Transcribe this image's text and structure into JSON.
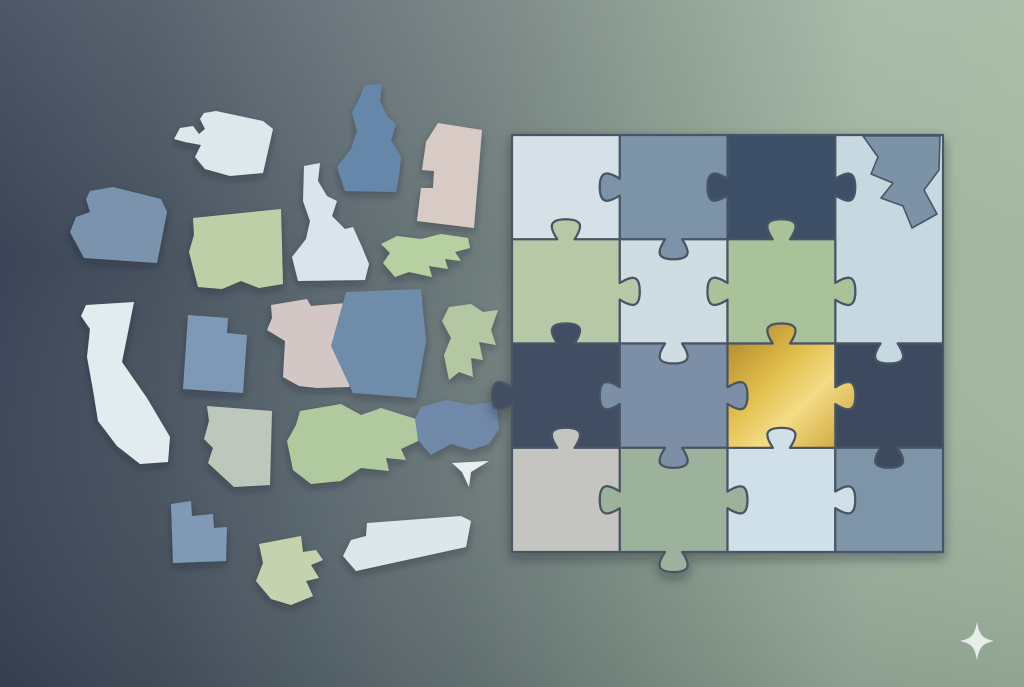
{
  "canvas": {
    "width": 1024,
    "height": 687
  },
  "background": {
    "horizontal_stops": [
      {
        "offset": "0%",
        "color": "#3a4457"
      },
      {
        "offset": "15%",
        "color": "#47525f"
      },
      {
        "offset": "32%",
        "color": "#5c6970"
      },
      {
        "offset": "48%",
        "color": "#6f7d7c"
      },
      {
        "offset": "66%",
        "color": "#879a8c"
      },
      {
        "offset": "84%",
        "color": "#9fb3a0"
      },
      {
        "offset": "100%",
        "color": "#a3b7a0"
      }
    ],
    "vertical_overlay_stops": [
      {
        "offset": "0%",
        "color": "rgba(255,255,255,0.10)"
      },
      {
        "offset": "38%",
        "color": "rgba(255,255,255,0)"
      },
      {
        "offset": "100%",
        "color": "rgba(12,22,32,0.12)"
      }
    ]
  },
  "scattered_states": [
    {
      "name": "washington-state",
      "color": "#dde8ec",
      "points": "204,113 216,111 263,121 273,129 263,173 230,176 205,169 195,157 201,145 185,142 174,139 180,128 193,126 199,134 205,129 200,119"
    },
    {
      "name": "idaho-state",
      "color": "#6587aa",
      "points": "365,85 382,84 380,101 387,116 396,124 391,140 401,157 399,176 396,192 345,191 337,167 351,149 357,131 352,113 359,99"
    },
    {
      "name": "beige-tab-card",
      "color": "#d8cbc5",
      "points": "438,123 482,130 474,228 417,221 421,188 433,188 434,171 422,170 426,142"
    },
    {
      "name": "oregon-state",
      "color": "#7b93ad",
      "points": "90,191 113,187 161,199 167,212 157,263 84,258 70,232 76,217 90,212 86,199"
    },
    {
      "name": "montana-state",
      "color": "#bccfa6",
      "points": "193,218 281,209 283,284 259,288 241,281 222,289 198,287 189,252 194,235"
    },
    {
      "name": "idaho-light-state",
      "color": "#d9e5ea",
      "points": "304,166 320,163 318,181 327,196 337,201 332,216 345,229 353,227 362,247 369,264 365,280 298,281 292,257 306,239 310,221 303,201"
    },
    {
      "name": "jagged-green-strip",
      "color": "#b7d0a2",
      "points": "381,244 397,236 421,239 441,234 468,238 470,248 455,252 461,261 445,259 448,269 429,266 432,277 409,272 395,277 383,263 390,253"
    },
    {
      "name": "california-state",
      "color": "#e2ebee",
      "points": "86,305 134,302 122,362 147,398 170,437 168,462 140,464 117,446 98,421 93,390 87,357 90,329 81,316"
    },
    {
      "name": "utah-state",
      "color": "#7e99b5",
      "points": "188,315 228,318 227,333 247,335 243,393 183,389"
    },
    {
      "name": "missouri-state",
      "color": "#d2c7c4",
      "points": "271,305 307,299 311,306 346,303 352,313 345,321 354,332 357,369 349,387 317,388 299,386 283,377 285,341 267,330 272,318"
    },
    {
      "name": "blue-slab-state",
      "color": "#6f8cab",
      "points": "346,292 421,289 426,341 416,398 353,393 331,346 339,317"
    },
    {
      "name": "green-fragment-state",
      "color": "#b3c7a2",
      "points": "449,307 471,304 483,312 498,310 491,330 496,345 479,342 483,360 471,358 473,377 459,372 449,380 444,355 451,338 442,321"
    },
    {
      "name": "arizona-state",
      "color": "#bec7bb",
      "points": "207,406 272,411 270,485 234,487 208,463 213,448 204,439 209,421"
    },
    {
      "name": "kentucky-state",
      "color": "#b0c99f",
      "points": "300,411 341,404 361,415 381,408 416,419 418,441 401,449 406,460 386,458 389,471 361,468 341,481 311,484 293,470 287,441 296,425"
    },
    {
      "name": "ohio-state",
      "color": "#7089a8",
      "points": "421,407 446,400 471,405 496,401 499,429 489,444 471,450 451,444 431,455 418,440 415,419"
    },
    {
      "name": "paper-funnel-shape",
      "color": "#e9eff1",
      "points": "452,463 489,461 471,472 469,487 462,472"
    },
    {
      "name": "utah-small-state",
      "color": "#8099b4",
      "points": "171,504 191,501 192,516 213,514 214,528 227,527 226,561 173,563"
    },
    {
      "name": "green-boot-state",
      "color": "#c4d3ad",
      "points": "259,544 301,536 303,552 316,550 323,560 311,565 319,578 306,581 313,596 291,605 271,599 256,581 263,563"
    },
    {
      "name": "tennessee-light-state",
      "color": "#dde7eb",
      "points": "351,540 366,536 367,523 461,516 471,521 466,547 356,571 343,556"
    }
  ],
  "puzzle": {
    "origin_x": 512,
    "origin_y": 135,
    "cols": 4,
    "rows": 4,
    "cell_width": 107.75,
    "cell_height": 104.25,
    "tab_depth": 20,
    "stroke_color": "#4a5565",
    "stroke_width": 2.2,
    "gold_gradient_stops": [
      {
        "offset": "0%",
        "color": "#ab8226"
      },
      {
        "offset": "40%",
        "color": "#e3bf4e"
      },
      {
        "offset": "62%",
        "color": "#f3dc85"
      },
      {
        "offset": "100%",
        "color": "#c99f33"
      }
    ],
    "h_tabs": [
      [
        0,
        0,
        0,
        0
      ],
      [
        1,
        -1,
        1,
        0
      ],
      [
        1,
        -1,
        1,
        -1
      ],
      [
        1,
        -1,
        1,
        -1
      ],
      [
        0,
        -1,
        0,
        0
      ]
    ],
    "v_tabs": [
      [
        0,
        1,
        1,
        -1,
        0
      ],
      [
        0,
        -1,
        1,
        -1,
        0
      ],
      [
        1,
        1,
        -1,
        -1,
        0
      ],
      [
        0,
        1,
        -1,
        -1,
        0
      ]
    ],
    "pieces": [
      {
        "name": "puzzle-piece-r1c1",
        "r": 0,
        "c": 0,
        "color": "#d5e1e7"
      },
      {
        "name": "puzzle-piece-r1c2",
        "r": 0,
        "c": 1,
        "color": "#7d94a8"
      },
      {
        "name": "puzzle-piece-r1c3",
        "r": 0,
        "c": 2,
        "color": "#3e4f66"
      },
      {
        "name": "puzzle-piece-r1c4-tall",
        "r": 0,
        "c": 3,
        "rs": 2,
        "color": "#c6d9e1"
      },
      {
        "name": "puzzle-piece-r2c1",
        "r": 1,
        "c": 0,
        "color": "#b7c8a6"
      },
      {
        "name": "puzzle-piece-r2c2",
        "r": 1,
        "c": 1,
        "color": "#cfdde2"
      },
      {
        "name": "puzzle-piece-r2c3",
        "r": 1,
        "c": 2,
        "color": "#a9c299"
      },
      {
        "name": "puzzle-piece-r3c1",
        "r": 2,
        "c": 0,
        "color": "#3f4e64"
      },
      {
        "name": "puzzle-piece-r3c2",
        "r": 2,
        "c": 1,
        "color": "#7b8fa6"
      },
      {
        "name": "puzzle-piece-r3c4",
        "r": 2,
        "c": 3,
        "color": "#3c4a5f"
      },
      {
        "name": "puzzle-piece-r4c1",
        "r": 3,
        "c": 0,
        "color": "#c4c5c0"
      },
      {
        "name": "puzzle-piece-r4c2",
        "r": 3,
        "c": 1,
        "color": "#9cb29d"
      },
      {
        "name": "puzzle-piece-r4c3",
        "r": 3,
        "c": 2,
        "color": "#cfe0e8"
      },
      {
        "name": "puzzle-piece-r4c4",
        "r": 3,
        "c": 3,
        "color": "#7e95a9"
      },
      {
        "name": "golden-puzzle-piece",
        "r": 2,
        "c": 2,
        "color": "gold"
      }
    ],
    "state_cutout": {
      "name": "state-shape-cutout",
      "color": "#7b92a6",
      "points": "863,136 940,136 939,170 924,190 937,214 912,228 903,206 881,198 893,183 871,174 878,157"
    }
  },
  "sparkle": {
    "name": "sparkle-icon",
    "color": "#e7eee8",
    "cx": 977,
    "cy": 641,
    "rx": 17,
    "ry": 19
  }
}
